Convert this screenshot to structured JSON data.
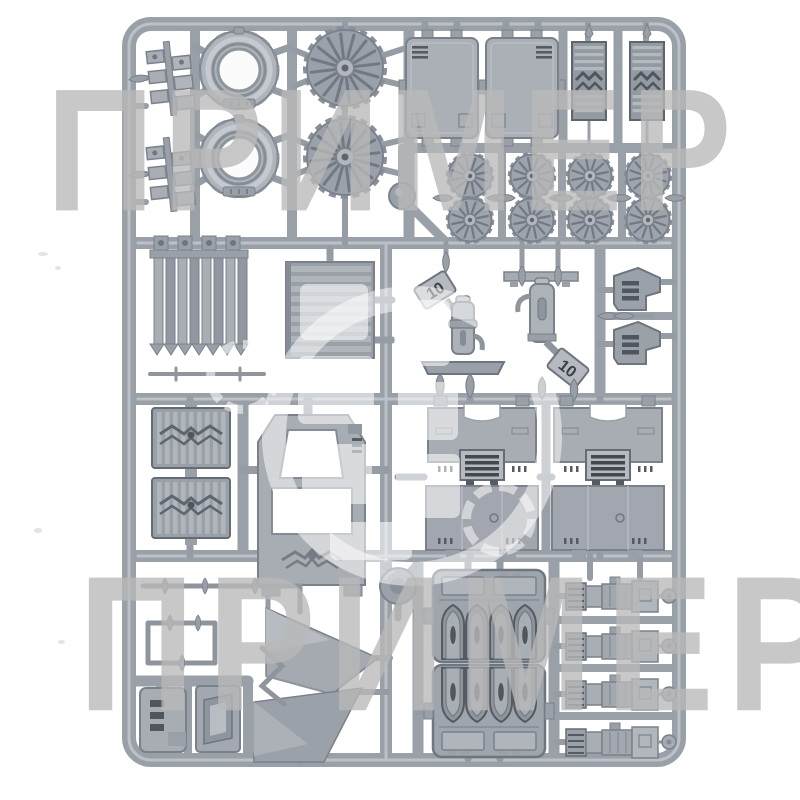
{
  "image": {
    "kind": "product-photo",
    "subject": "grey plastic model-kit sprue (frame of clip-off vehicle parts)",
    "background": "#ffffff"
  },
  "watermark": {
    "top": "ПРИМЕР",
    "bottom": "ПРИМЕР",
    "ink": "#b9b9b9",
    "center": "white translucent circular logo"
  },
  "sprue": {
    "colors": {
      "plastic": "#a6abb3",
      "rail": "#9aa0a8",
      "outline": "#7b818a",
      "dark_detail": "#565b63",
      "highlight": "#c6cad0"
    },
    "molded_part_numbers": [
      "10",
      "10"
    ],
    "parts": [
      {
        "name": "injector-manifold",
        "count": 2
      },
      {
        "name": "engine-cowling-ring",
        "count": 2
      },
      {
        "name": "large-turbofan",
        "count": 2
      },
      {
        "name": "roof-hatch-panel",
        "count": 2
      },
      {
        "name": "louvre-armour-panel",
        "count": 2
      },
      {
        "name": "small-turbofan",
        "count": 8
      },
      {
        "name": "radiator-assembly",
        "count": 1
      },
      {
        "name": "vent-grille-panel",
        "count": 1
      },
      {
        "name": "suspension-strut",
        "count": 2
      },
      {
        "name": "slotted-bracket",
        "count": 2
      },
      {
        "name": "eagle-grille-panel",
        "count": 2
      },
      {
        "name": "cockpit-frame",
        "count": 1
      },
      {
        "name": "hull-roof-panel",
        "count": 2
      },
      {
        "name": "axle-rod",
        "count": 3
      },
      {
        "name": "turret-disc",
        "count": 1
      },
      {
        "name": "wing-panel",
        "count": 2
      },
      {
        "name": "arched-intake-housing",
        "count": 2
      },
      {
        "name": "heavy-weapon",
        "count": 4
      },
      {
        "name": "slotted-box",
        "count": 1
      },
      {
        "name": "duct-box",
        "count": 1
      },
      {
        "name": "bent-rod",
        "count": 1
      }
    ]
  }
}
